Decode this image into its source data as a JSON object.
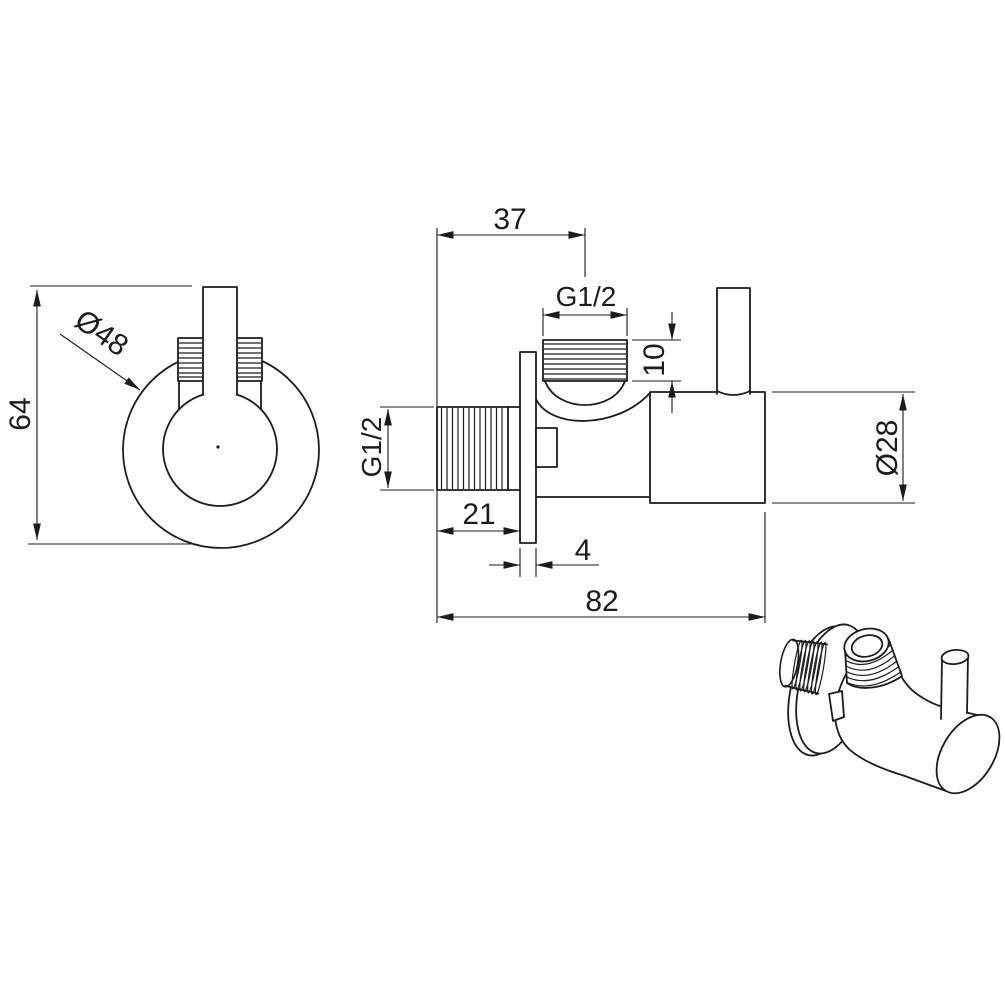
{
  "colors": {
    "line": "#1c1c1c",
    "background": "#ffffff"
  },
  "dims": {
    "front_height": "64",
    "front_diameter": "Ø48",
    "top_port_offset": "37",
    "top_port_thread": "G1/2",
    "top_port_thread_length": "10",
    "inlet_thread": "G1/2",
    "inlet_thread_length": "21",
    "wall_plate_thickness": "4",
    "overall_length": "82",
    "body_diameter": "Ø28"
  }
}
